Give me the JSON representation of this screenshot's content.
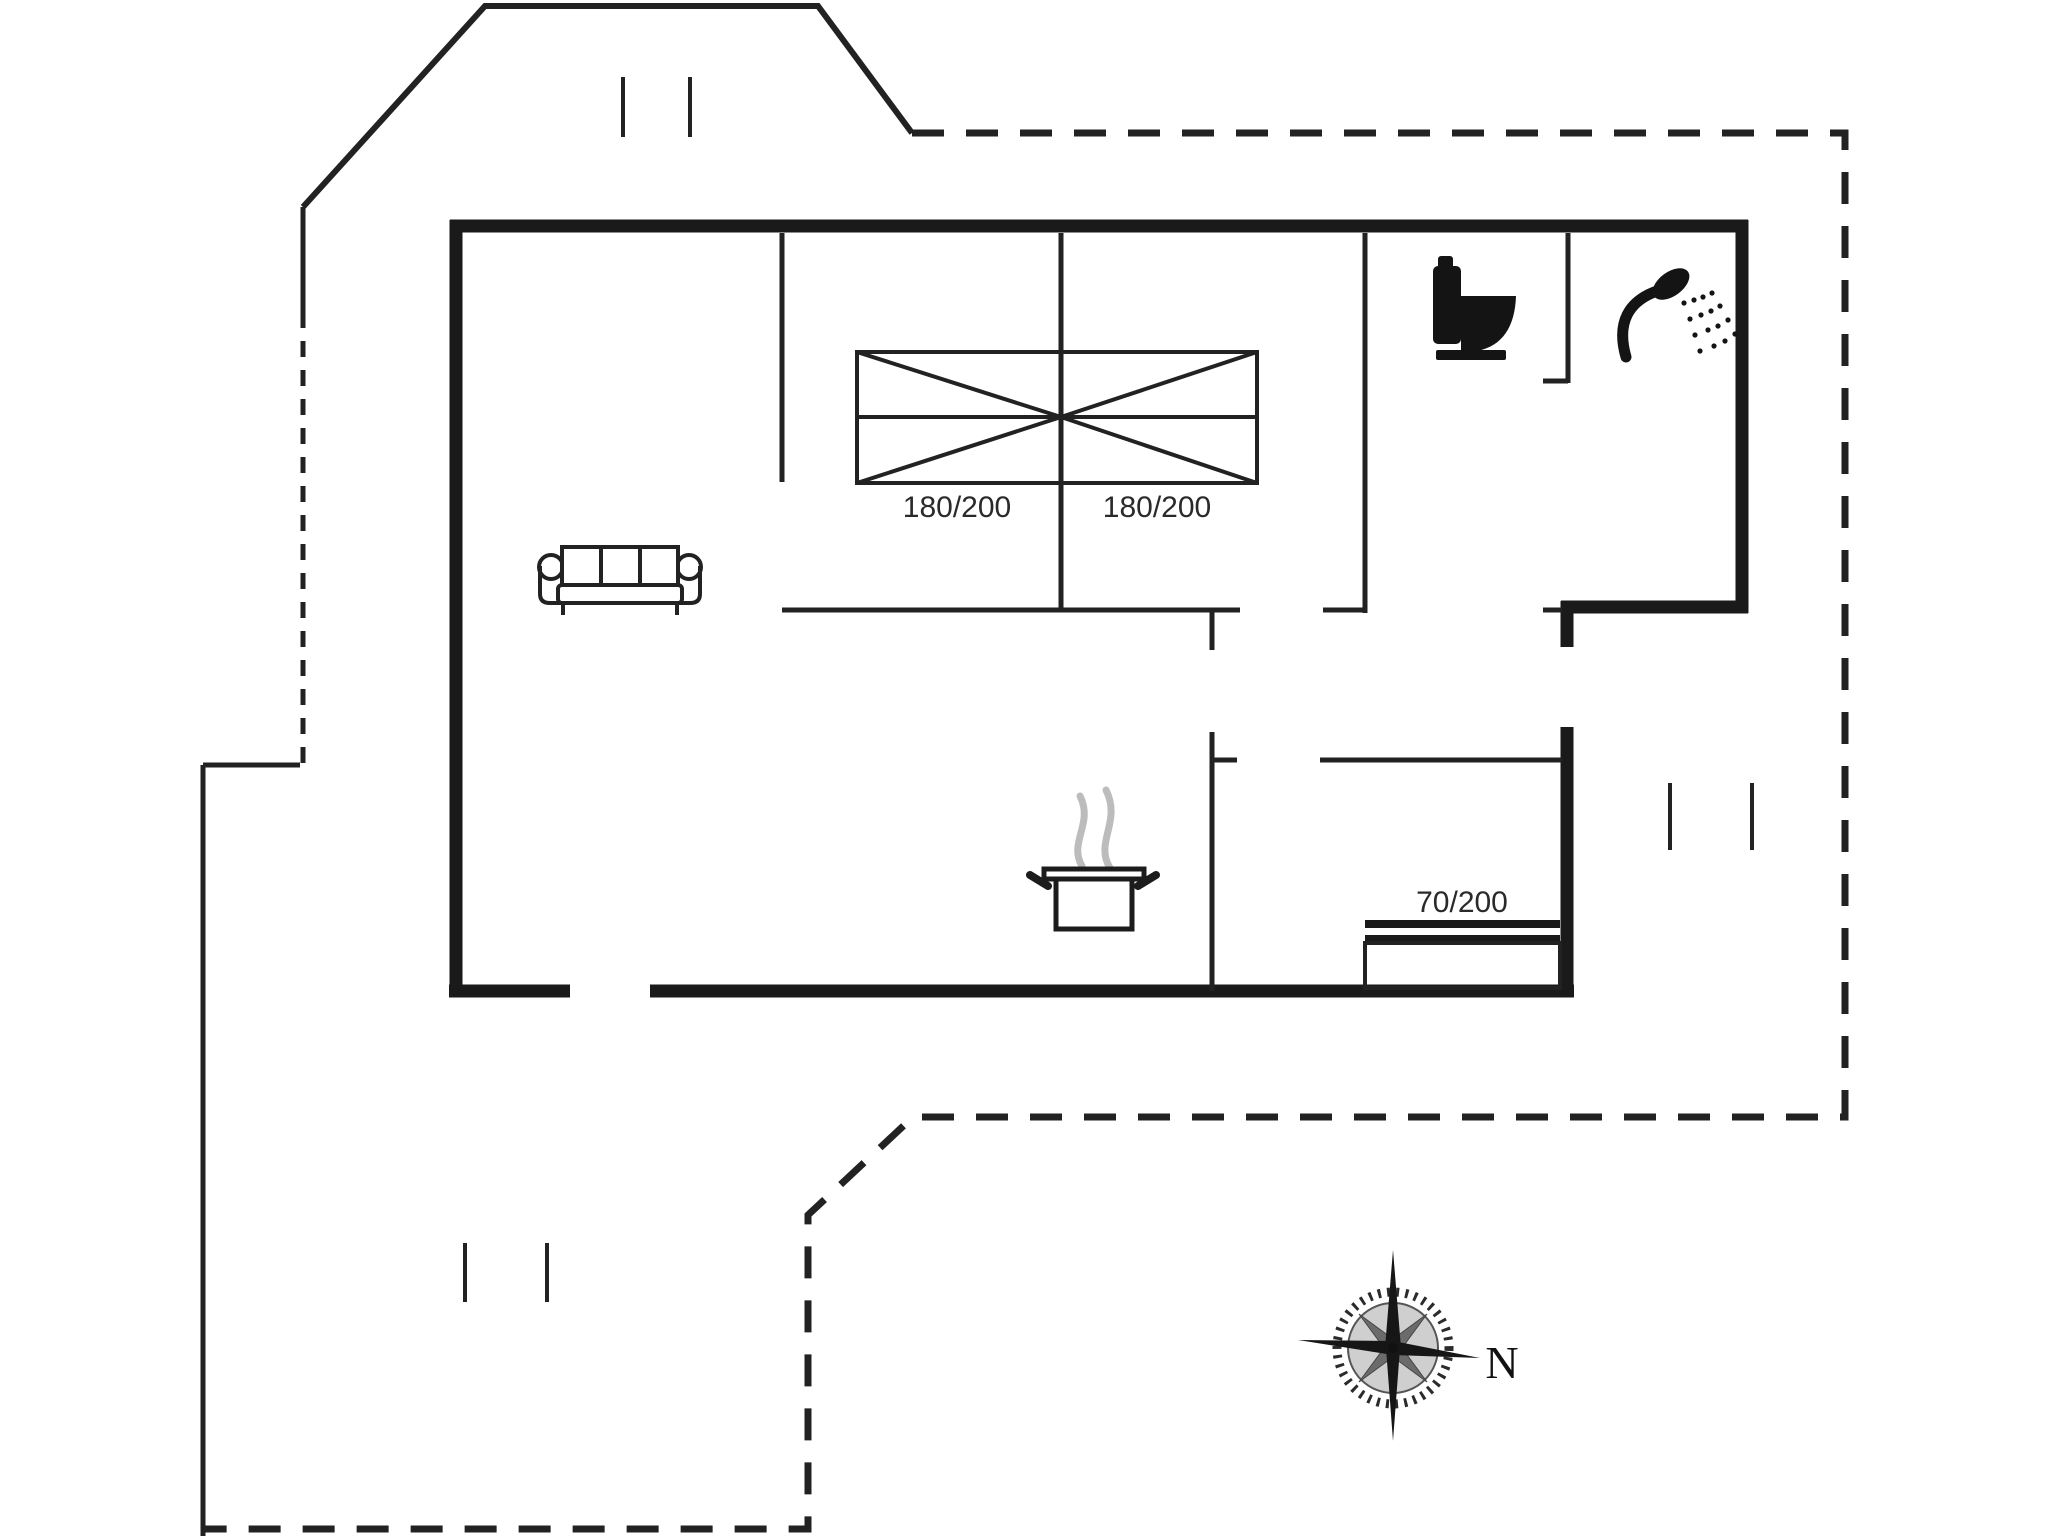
{
  "title": "Holiday house floor plan",
  "floorplan": {
    "labels": {
      "bed1": "180/200",
      "bed2": "180/200",
      "bunk": "70/200"
    },
    "compass": {
      "north": "N"
    },
    "icons": [
      "double-bed-icon",
      "bunk-bed-icon",
      "sofa-icon",
      "cooking-pot-icon",
      "steam-icon",
      "toilet-icon",
      "shower-head-icon",
      "compass-rose-icon",
      "window-mark-icon",
      "plot-boundary",
      "roof-outline"
    ],
    "colors": {
      "walls": "#1a1a1a",
      "lines": "#222222",
      "background": "#ffffff",
      "steam": "#bcbcbc",
      "labels": "#2a2a2a"
    }
  }
}
